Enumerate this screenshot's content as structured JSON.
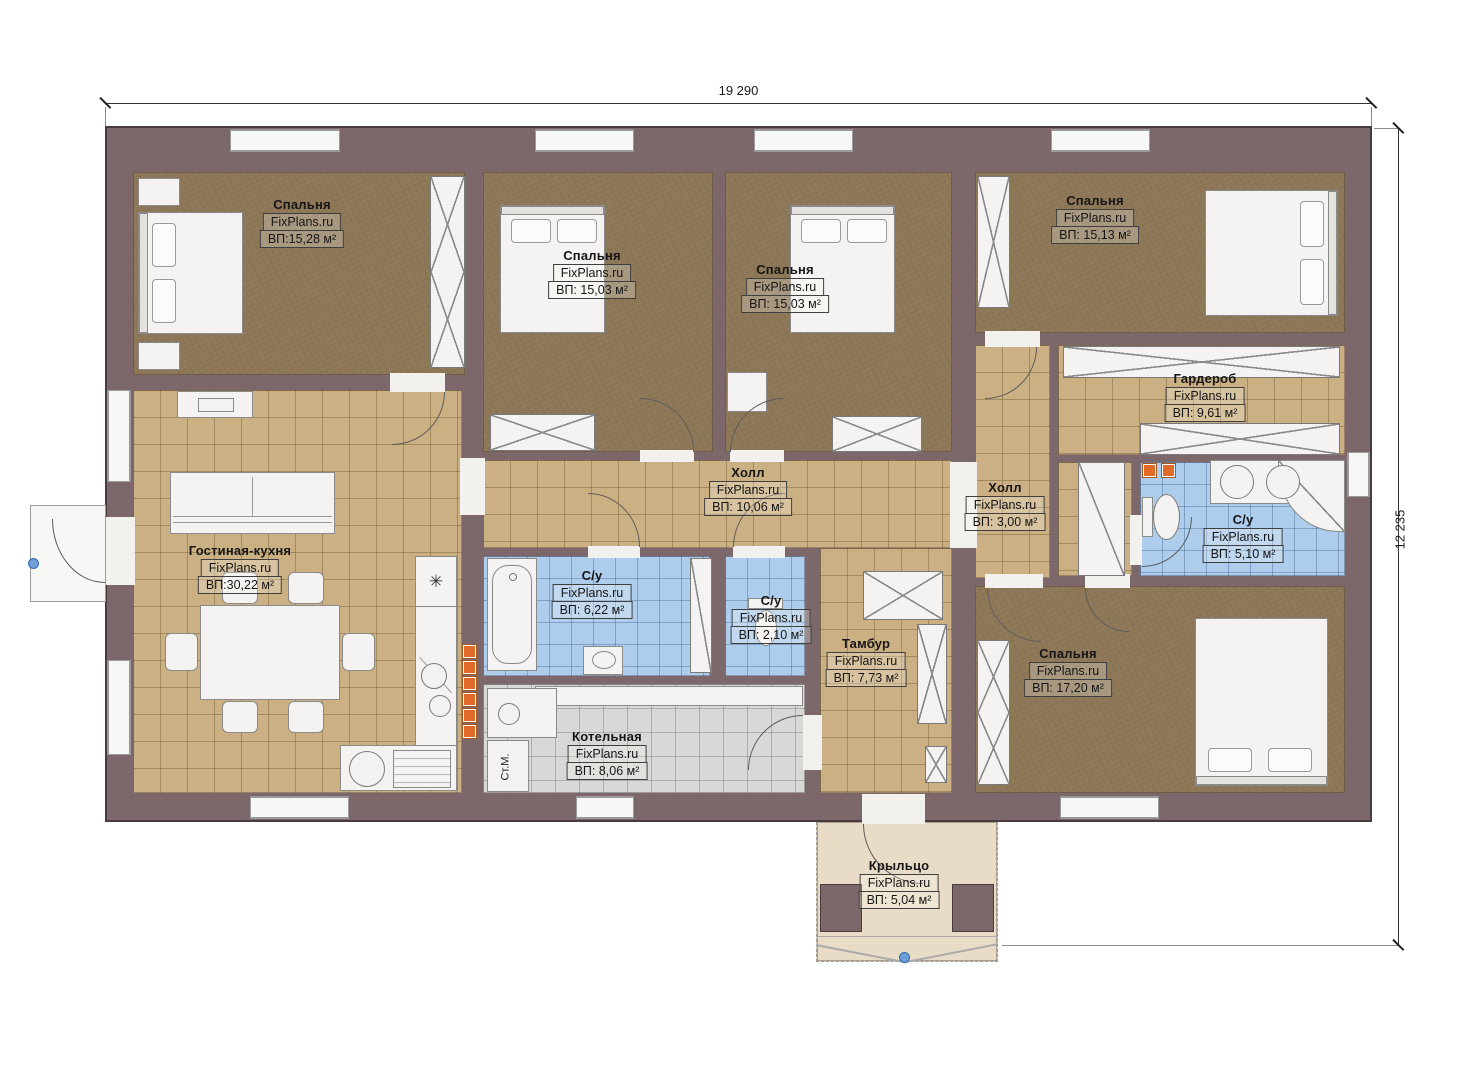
{
  "dimensions": {
    "width_label": "19 290",
    "height_label": "12 235"
  },
  "watermark": "FixPlans.ru",
  "rooms": [
    {
      "id": "bedroom-1",
      "name": "Спальня",
      "area": "ВП:15,28 м²"
    },
    {
      "id": "bedroom-2",
      "name": "Спальня",
      "area": "ВП: 15,03 м²"
    },
    {
      "id": "bedroom-3",
      "name": "Спальня",
      "area": "ВП: 15,03 м²"
    },
    {
      "id": "bedroom-4",
      "name": "Спальня",
      "area": "ВП: 15,13 м²"
    },
    {
      "id": "wardrobe",
      "name": "Гардероб",
      "area": "ВП: 9,61 м²"
    },
    {
      "id": "hall-main",
      "name": "Холл",
      "area": "ВП: 10,06 м²"
    },
    {
      "id": "hall-small",
      "name": "Холл",
      "area": "ВП: 3,00 м²"
    },
    {
      "id": "bathroom-master",
      "name": "С/у",
      "area": "ВП: 5,10 м²"
    },
    {
      "id": "bathroom-main",
      "name": "С/у",
      "area": "ВП: 6,22 м²"
    },
    {
      "id": "bathroom-guest",
      "name": "С/у",
      "area": "ВП: 2,10 м²"
    },
    {
      "id": "vestibule",
      "name": "Тамбур",
      "area": "ВП: 7,73 м²"
    },
    {
      "id": "boiler-room",
      "name": "Котельная",
      "area": "ВП: 8,06 м²"
    },
    {
      "id": "living-kitchen",
      "name": "Гостиная-кухня",
      "area": "ВП:30,22 м²"
    },
    {
      "id": "bedroom-5",
      "name": "Спальня",
      "area": "ВП: 17,20 м²"
    },
    {
      "id": "porch",
      "name": "Крыльцо",
      "area": "ВП: 5,04 м²"
    }
  ],
  "labels": {
    "washing_machine": "Ст.М."
  },
  "symbols": {
    "cooktop": "✳"
  }
}
